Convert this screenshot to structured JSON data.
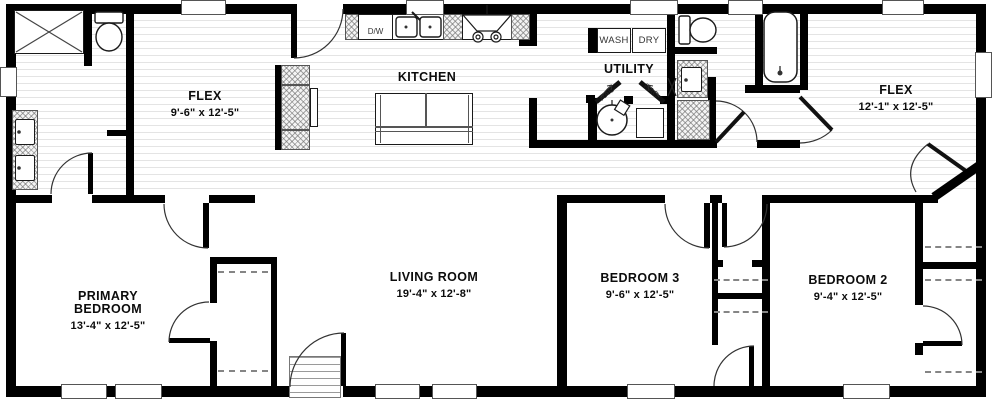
{
  "plan_title": "Home floor plan",
  "rooms": {
    "flex_left": {
      "name": "FLEX",
      "dims": "9'-6\" x 12'-5\""
    },
    "kitchen": {
      "name": "KITCHEN",
      "dims": ""
    },
    "utility": {
      "name": "UTILITY",
      "dims": ""
    },
    "flex_right": {
      "name": "FLEX",
      "dims": "12'-1\" x 12'-5\""
    },
    "primary_bedroom": {
      "name": "PRIMARY BEDROOM",
      "dims": "13'-4\" x 12'-5\""
    },
    "living_room": {
      "name": "LIVING ROOM",
      "dims": "19'-4\" x 12'-8\""
    },
    "bedroom3": {
      "name": "BEDROOM 3",
      "dims": "9'-6\" x 12'-5\""
    },
    "bedroom2": {
      "name": "BEDROOM 2",
      "dims": "9'-4\" x 12'-5\""
    }
  },
  "appliances": {
    "dishwasher": "D/W",
    "washer": "WASH",
    "dryer": "DRY",
    "rack_left": "RAC",
    "rack_right": "RAC"
  },
  "colors": {
    "wall": "#000000",
    "floor_stripe": "#e4e4e4",
    "fixture_outline": "#1a1a1a"
  }
}
